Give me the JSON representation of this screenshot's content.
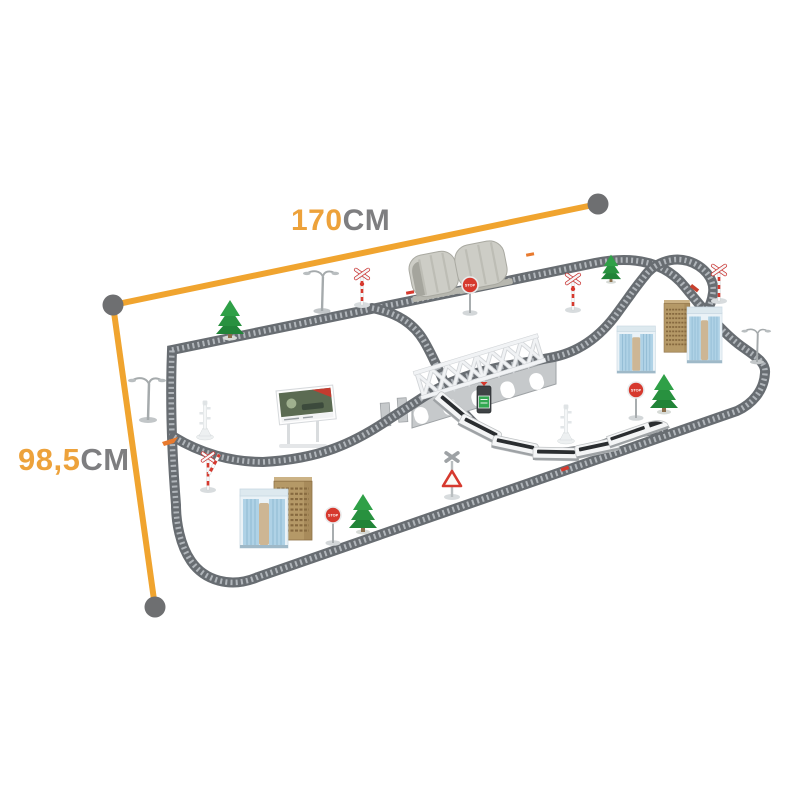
{
  "image": {
    "type": "product-dimensions-photo",
    "subject": "toy electric train track set with tunnel, bridge, buildings and signals",
    "background_color": "#ffffff"
  },
  "dimension_annotations": {
    "width": {
      "value": "170",
      "unit": "CM"
    },
    "depth": {
      "value": "98,5",
      "unit": "CM"
    },
    "line_color": "#F0A42F",
    "endpoint_dot_color": "#6E6F71",
    "value_text_color": "#EDA23B",
    "unit_text_color": "#7E7E80"
  },
  "scene": {
    "stop_sign_text": "STOP",
    "track_color": "#686D72",
    "elements": {
      "tunnel_sections": 2,
      "truss_bridge_spans": 2,
      "train_cars": 6,
      "skyscrapers_right": 3,
      "skyscrapers_left": 2,
      "trees": 4,
      "street_lamps": 3,
      "stop_signs": 3,
      "crossing_signals": 5,
      "signal_towers": 2,
      "billboards": 1
    }
  }
}
